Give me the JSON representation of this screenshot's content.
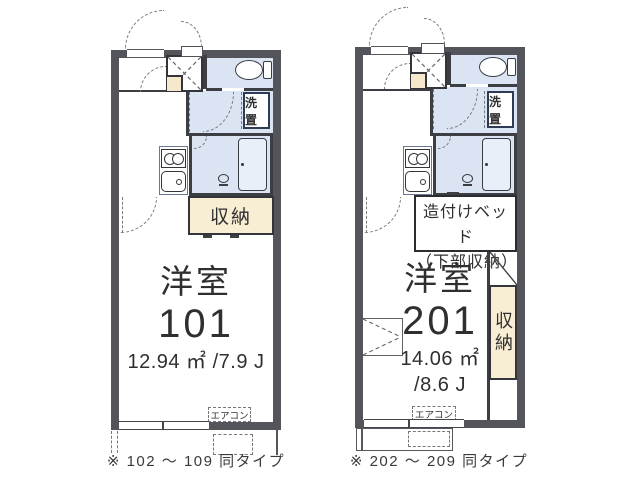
{
  "colors": {
    "wall": "#53555b",
    "wet_area": "#dae4f3",
    "bathtub": "#e9eff9",
    "storage_cream": "#f8eed4",
    "entry_step_cream": "#f6e8cc",
    "line": "#33353a",
    "dash": "#777777",
    "text": "#2f2f2f"
  },
  "p101": {
    "room_type": "洋室",
    "room_number": "101",
    "area": "12.94 ㎡ /7.9 J",
    "storage_label": "収納",
    "laundry_label": "洗置",
    "aircon_label": "エアコン",
    "caption": "※ 102 ～ 109 同タイプ"
  },
  "p201": {
    "room_type": "洋室",
    "room_number": "201",
    "area_m2": "14.06 ㎡",
    "area_jo": "/8.6 J",
    "bed_label_line1": "造付けベッド",
    "bed_label_line2": "（下部収納）",
    "storage_label": "収納",
    "laundry_label": "洗置",
    "aircon_label": "エアコン",
    "caption": "※ 202 ～ 209 同タイプ"
  }
}
